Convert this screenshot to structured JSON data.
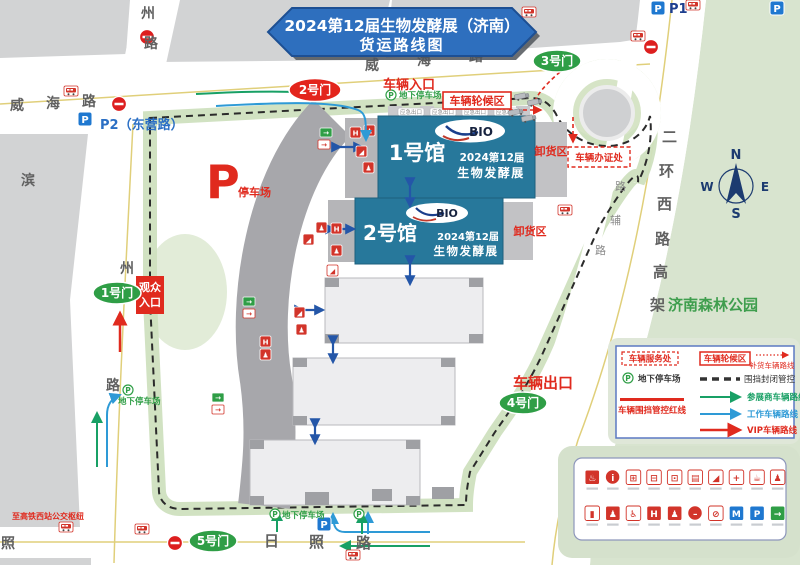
{
  "banner": {
    "line1": "2024第12届生物发酵展（济南）",
    "line2": "货运路线图"
  },
  "roads": {
    "weihai_left": [
      "威",
      "海",
      "路"
    ],
    "weihai_top": [
      "威",
      "海",
      "路"
    ],
    "zhou_top": [
      "州",
      "路"
    ],
    "binzhou": [
      "滨",
      "州",
      "路"
    ],
    "rizhao_left": "照",
    "rizhao": [
      "日",
      "照",
      "路"
    ],
    "erhuan": [
      "二",
      "环",
      "西",
      "路",
      "高",
      "架"
    ],
    "fulu": [
      "路",
      "辅",
      "路"
    ],
    "dongying_parking": "P2（东营路）",
    "p1": "P1"
  },
  "gates": {
    "g1": "1号门",
    "g2": "2号门",
    "g3": "3号门",
    "g4": "4号门",
    "g5": "5号门"
  },
  "halls": {
    "h1": {
      "name": "1号馆",
      "logo": "BIO",
      "line1": "2024第12届",
      "line2": "生物发酵展"
    },
    "h2": {
      "name": "2号馆",
      "logo": "BIO",
      "line1": "2024第12届",
      "line2": "生物发酵展"
    }
  },
  "labels": {
    "vehicle_entrance": "车辆入口",
    "vehicle_exit": "车辆出口",
    "visitor_entrance_l1": "观众",
    "visitor_entrance_l2": "入口",
    "unloading_area": "卸货区",
    "waiting_area": "车辆轮候区",
    "permit_office": "车辆办证处",
    "parking_big_p": "P",
    "parking_lot": "停车场",
    "underground_parking": "地下停车场",
    "bus_hub": "至高铁西站公交枢纽",
    "forest_park": "济南森林公园",
    "emergency_exit": "应急出口",
    "p_letter": "P"
  },
  "compass": {
    "n": "N",
    "e": "E",
    "s": "S",
    "w": "W"
  },
  "legend": {
    "service_office": "车辆服务处",
    "waiting_area": "车辆轮候区",
    "restock_route": "补货车辆路线",
    "underground_parking": "地下停车场",
    "fence_control": "围挡封闭管控",
    "fence_redline": "车辆围挡管控红线",
    "exhibitor_route": "参展商车辆路线",
    "staff_route": "工作车辆路线",
    "vip_route": "VIP车辆路线"
  },
  "colors": {
    "hall_teal": "#27789b",
    "banner_blue": "#2e6fbe",
    "gate_green": "#2f9e46",
    "alert_red": "#e02a1e",
    "route_green": "#18a065",
    "route_blue": "#2e9ad6",
    "park_green": "#d8e4cf"
  },
  "panel_icons": [
    {
      "name": "fire-hydrant-icon",
      "g": "♨",
      "shape": "sq",
      "bg": "#d2342a",
      "fg": "#ffffff"
    },
    {
      "name": "information-icon",
      "g": "i",
      "shape": "circle",
      "bg": "#d2342a",
      "fg": "#ffffff"
    },
    {
      "name": "bus-stop-icon",
      "g": "⊞",
      "shape": "sq",
      "bg": "#ffffff",
      "fg": "#d2342a"
    },
    {
      "name": "coach-icon",
      "g": "⊟",
      "shape": "sq",
      "bg": "#ffffff",
      "fg": "#d2342a"
    },
    {
      "name": "car-icon",
      "g": "⊡",
      "shape": "sq",
      "bg": "#ffffff",
      "fg": "#d2342a"
    },
    {
      "name": "ticket-icon",
      "g": "▤",
      "shape": "sq",
      "bg": "#ffffff",
      "fg": "#d2342a"
    },
    {
      "name": "escalator-icon",
      "g": "◢",
      "shape": "sq",
      "bg": "#ffffff",
      "fg": "#d2342a"
    },
    {
      "name": "first-aid-icon",
      "g": "+",
      "shape": "sq",
      "bg": "#ffffff",
      "fg": "#d2342a"
    },
    {
      "name": "beverage-icon",
      "g": "☕",
      "shape": "sq",
      "bg": "#ffffff",
      "fg": "#d2342a"
    },
    {
      "name": "passenger-icon",
      "g": "♟",
      "shape": "sq",
      "bg": "#ffffff",
      "fg": "#d2342a"
    },
    {
      "name": "water-refill-icon",
      "g": "▮",
      "shape": "sq",
      "bg": "#ffffff",
      "fg": "#d2342a"
    },
    {
      "name": "crowd-icon",
      "g": "♟",
      "shape": "sq",
      "bg": "#d2342a",
      "fg": "#ffffff"
    },
    {
      "name": "wheelchair-icon",
      "g": "♿",
      "shape": "sq",
      "bg": "#ffffff",
      "fg": "#d2342a"
    },
    {
      "name": "toilet-icon",
      "g": "H",
      "shape": "sq",
      "bg": "#d2342a",
      "fg": "#ffffff"
    },
    {
      "name": "family-restroom-icon",
      "g": "♟",
      "shape": "sq",
      "bg": "#d2342a",
      "fg": "#ffffff"
    },
    {
      "name": "no-entry-icon",
      "g": "–",
      "shape": "circle",
      "bg": "#d2342a",
      "fg": "#ffffff"
    },
    {
      "name": "no-pets-icon",
      "g": "⊘",
      "shape": "sq",
      "bg": "#ffffff",
      "fg": "#d2342a"
    },
    {
      "name": "metro-icon",
      "g": "M",
      "shape": "sq",
      "bg": "#1f78d0",
      "fg": "#ffffff"
    },
    {
      "name": "parking-icon",
      "g": "P",
      "shape": "sq",
      "bg": "#1f78d0",
      "fg": "#ffffff"
    },
    {
      "name": "exit-icon",
      "g": "→",
      "shape": "sq",
      "bg": "#2f9e46",
      "fg": "#ffffff"
    }
  ]
}
